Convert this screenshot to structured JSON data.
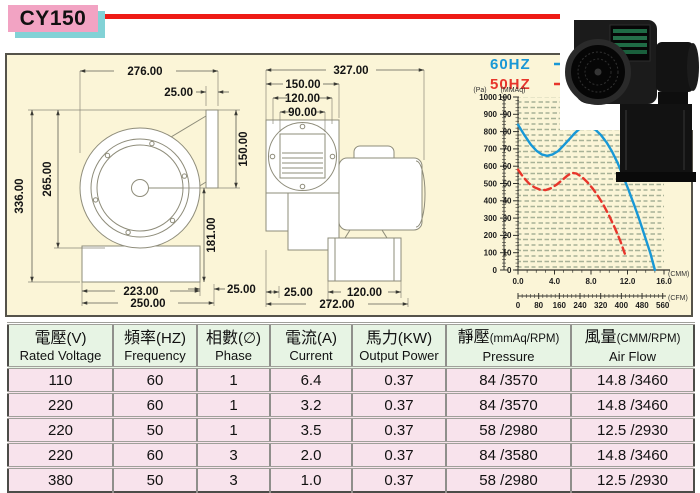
{
  "title": "CY150",
  "drawings": {
    "front": {
      "dim_width": "276.00",
      "dim_flange": "25.00",
      "dim_outlet_h": "150.00",
      "dim_total_h": "336.00",
      "dim_body_h": "265.00",
      "dim_center_h": "181.00",
      "dim_base_offset": "25.00",
      "dim_base_w": "223.00",
      "dim_total_w": "250.00"
    },
    "side": {
      "dim_total_w": "327.00",
      "dim_flange_w": "150.00",
      "dim_bolt_w": "120.00",
      "dim_opening_w": "90.00",
      "dim_foot_offset": "25.00",
      "dim_foot_w": "120.00",
      "dim_overall_w": "272.00"
    }
  },
  "chart_data": {
    "type": "line",
    "legend_position": "top-left",
    "grid": true,
    "series": [
      {
        "name": "60HZ",
        "color": "#1898d6",
        "style": "solid",
        "points": [
          [
            0,
            84
          ],
          [
            0.7,
            78
          ],
          [
            1.4,
            72.5
          ],
          [
            2,
            69
          ],
          [
            2.6,
            66.8
          ],
          [
            3.2,
            66
          ],
          [
            3.8,
            66.8
          ],
          [
            4.4,
            68.8
          ],
          [
            5,
            72
          ],
          [
            5.6,
            75.5
          ],
          [
            6.2,
            79
          ],
          [
            6.8,
            81.8
          ],
          [
            7.3,
            83
          ],
          [
            7.9,
            82.8
          ],
          [
            8.5,
            81
          ],
          [
            9.1,
            78
          ],
          [
            9.7,
            73.8
          ],
          [
            10.3,
            68.5
          ],
          [
            10.9,
            62
          ],
          [
            11.5,
            54.5
          ],
          [
            12.1,
            46.5
          ],
          [
            12.7,
            38
          ],
          [
            13.3,
            29
          ],
          [
            13.9,
            19.5
          ],
          [
            14.5,
            9.8
          ],
          [
            15,
            0
          ]
        ]
      },
      {
        "name": "50HZ",
        "color": "#e7352a",
        "style": "dashed",
        "points": [
          [
            0,
            58
          ],
          [
            0.6,
            53.5
          ],
          [
            1.2,
            50
          ],
          [
            1.8,
            47.8
          ],
          [
            2.4,
            46.5
          ],
          [
            3,
            46.2
          ],
          [
            3.6,
            47.2
          ],
          [
            4.2,
            49.2
          ],
          [
            4.8,
            51.8
          ],
          [
            5.4,
            54.5
          ],
          [
            5.9,
            56.2
          ],
          [
            6.4,
            55.8
          ],
          [
            7,
            53.8
          ],
          [
            7.6,
            50.8
          ],
          [
            8.2,
            47
          ],
          [
            8.8,
            42.5
          ],
          [
            9.4,
            37.2
          ],
          [
            10,
            31.2
          ],
          [
            10.6,
            24.5
          ],
          [
            11.2,
            17
          ],
          [
            11.7,
            9.5
          ]
        ]
      }
    ],
    "y_axis_pa": {
      "label": "(Pa)",
      "ticks": [
        0,
        100,
        200,
        300,
        400,
        500,
        600,
        700,
        800,
        900,
        1000
      ],
      "range": [
        0,
        1000
      ]
    },
    "y_axis": {
      "label": "(MMAq)",
      "ticks": [
        0,
        10,
        20,
        30,
        40,
        50,
        60,
        70,
        80,
        90,
        100
      ],
      "range": [
        0,
        100
      ]
    },
    "x_axis": {
      "label": "(CMM)",
      "ticks": [
        "0.0",
        "4.0",
        "8.0",
        "12.0",
        "16.0"
      ],
      "range": [
        0,
        16
      ]
    },
    "x_axis2": {
      "label": "(CFM)",
      "ticks": [
        0,
        80,
        160,
        240,
        320,
        400,
        480,
        560
      ],
      "range": [
        0,
        565
      ]
    }
  },
  "table": {
    "headers": [
      {
        "zh": "電壓",
        "unit": "(V)",
        "en": "Rated Voltage",
        "small": false
      },
      {
        "zh": "頻率",
        "unit": "(HZ)",
        "en": "Frequency",
        "small": false
      },
      {
        "zh": "相數",
        "unit": "(∅)",
        "en": "Phase",
        "small": false
      },
      {
        "zh": "電流",
        "unit": "(A)",
        "en": "Current",
        "small": false
      },
      {
        "zh": "馬力",
        "unit": "(KW)",
        "en": "Output Power",
        "small": false
      },
      {
        "zh": "靜壓",
        "unit": "(mmAq/RPM)",
        "en": "Pressure",
        "small": true
      },
      {
        "zh": "風量",
        "unit": "(CMM/RPM)",
        "en": "Air Flow",
        "small": true
      }
    ],
    "rows": [
      [
        "110",
        "60",
        "1",
        "6.4",
        "0.37",
        "84 /3570",
        "14.8 /3460"
      ],
      [
        "220",
        "60",
        "1",
        "3.2",
        "0.37",
        "84 /3570",
        "14.8 /3460"
      ],
      [
        "220",
        "50",
        "1",
        "3.5",
        "0.37",
        "58 /2980",
        "12.5 /2930"
      ],
      [
        "220",
        "60",
        "3",
        "2.0",
        "0.37",
        "84 /3580",
        "14.8 /3460"
      ],
      [
        "380",
        "50",
        "3",
        "1.0",
        "0.37",
        "58 /2980",
        "12.5 /2930"
      ]
    ]
  }
}
